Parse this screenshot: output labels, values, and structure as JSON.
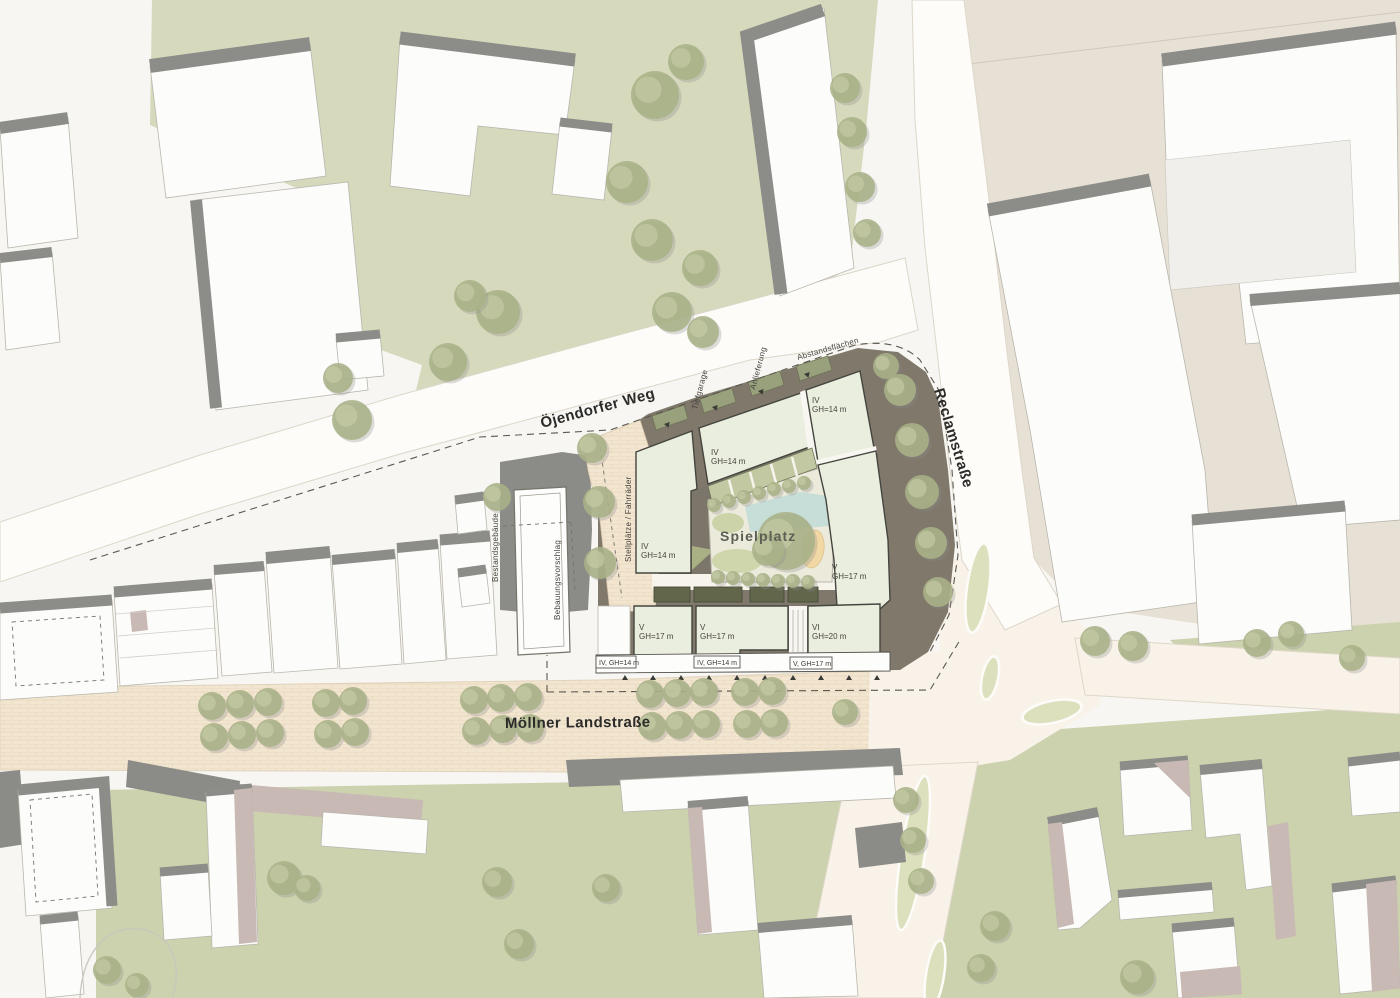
{
  "map": {
    "streets": {
      "ojendorfer_weg": "Öjendorfer Weg",
      "reclamstrasse": "Reclamstraße",
      "moellner_landstrasse": "Möllner Landstraße"
    },
    "annotations": {
      "spielplatz": "Spielplatz",
      "tiefgarage": "Tiefgarage",
      "anlieferung": "Anlieferung",
      "abstandsflaechen": "Abstandsflächen",
      "stellplaetze_fahrraeder": "Stellplätze / Fahrräder",
      "bestandsgebaeude": "Bestandsgebäude",
      "bebauungsvorschlag": "Bebauungsvorschlag"
    },
    "proposed_buildings": [
      {
        "storeys": "IV",
        "height": "GH=14 m"
      },
      {
        "storeys": "IV",
        "height": "GH=14 m"
      },
      {
        "storeys": "IV",
        "height": "GH=14 m"
      },
      {
        "storeys": "V",
        "height": "GH=17 m"
      },
      {
        "storeys": "V",
        "height": "GH=17 m"
      },
      {
        "storeys": "V",
        "height": "GH=17 m"
      },
      {
        "storeys": "VI",
        "height": "GH=20 m"
      }
    ],
    "setback_labels": [
      "IV, GH=14 m",
      "IV, GH=14 m",
      "V, GH=17 m"
    ],
    "colors": {
      "grass": "#d6d9bc",
      "grass_dark": "#ccd2ae",
      "beige_ground": "#e7e0d4",
      "brick_paving": "#f3e6d1",
      "road_cream": "#f9f2e8",
      "road_white": "#fdfcf9",
      "building_white": "#fcfcfa",
      "building_shadow": "#8c8c88",
      "roof_mauve": "#c9b9b4",
      "deck_gray": "#7f786b",
      "proposal_fill": "#eaeedf",
      "tree_green": "#a9b287",
      "tree_light": "#c6cda6",
      "water": "#c7ddd8",
      "sand": "#f2d8a4"
    }
  }
}
